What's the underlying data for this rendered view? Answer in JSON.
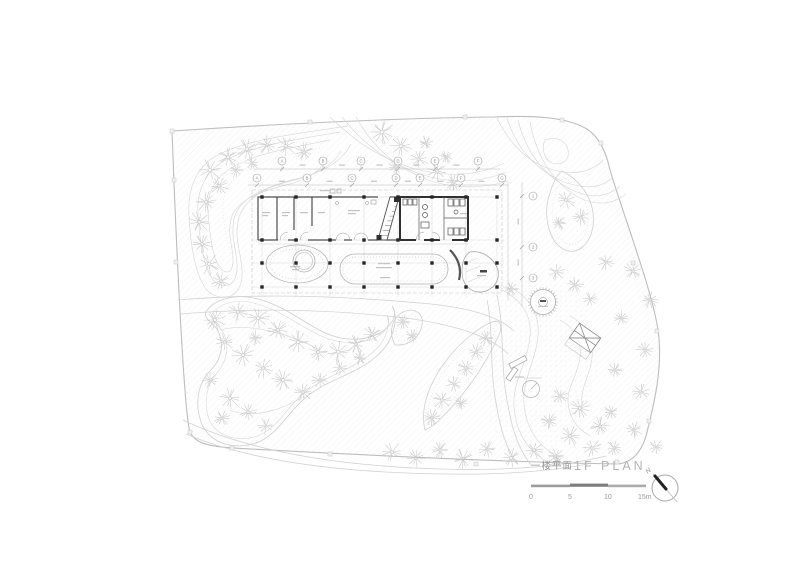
{
  "drawing": {
    "title_cn": "一楼平面",
    "title_en": "1F PLAN",
    "north_label": "N",
    "scale_labels": [
      "0",
      "5",
      "10",
      "15m"
    ],
    "grid_top": [
      "A",
      "B",
      "C",
      "D",
      "E",
      "F"
    ],
    "grid_mid": [
      "A",
      "B",
      "C",
      "D",
      "E",
      "F",
      "G"
    ],
    "grid_right": [
      "1",
      "2",
      "3"
    ],
    "colors": {
      "paper": "#ffffff",
      "line_light": "#d7d7d7",
      "line_mid": "#bdbdbd",
      "wall_dark": "#303030",
      "title_gray": "#a8a8a8"
    }
  }
}
